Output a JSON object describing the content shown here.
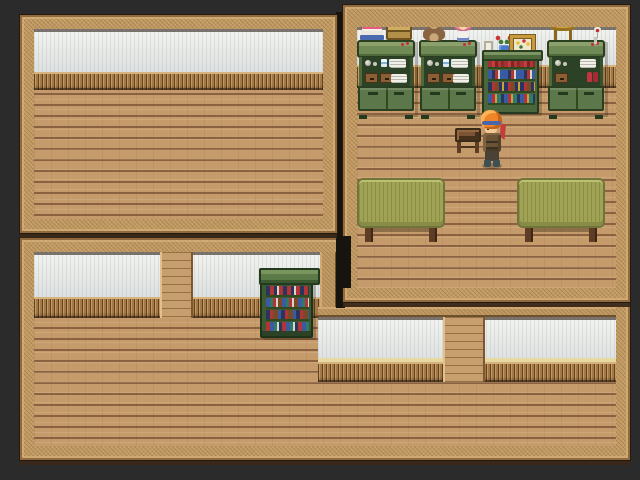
{
  "scene": {
    "type": "rpg-interior-map",
    "background_color": "#2b2b2b",
    "rooms": [
      {
        "id": "top-left-room",
        "label": "empty room"
      },
      {
        "id": "top-right-room",
        "label": "furnished room"
      },
      {
        "id": "bottom-room",
        "label": "long hall"
      }
    ]
  },
  "palette": {
    "bg": "#2b2b2b",
    "gap": "#17130f",
    "frame_base": "#c19a63",
    "wall_white": "#e7e8e4",
    "wainscot": "#b08351",
    "wainscot_rail": "#d7b27c",
    "floor": "#c59b6b",
    "floor_line": "#8a6241",
    "pillar": "#c79e6e",
    "furn_green": "#5c774a",
    "table_top": "#a1a354",
    "leg_brown": "#5f3d24",
    "hair_orange": "#ee8527",
    "headband_blue": "#4a66aa",
    "skin": "#f6c693",
    "outfit_brown": "#6d5134"
  },
  "entities": {
    "character": {
      "name": "player-character",
      "facing": "left"
    },
    "furniture": [
      {
        "id": "dresser-a",
        "items": [
          "book-stack",
          "briefcase",
          "glasses",
          "cups",
          "plates",
          "drawers"
        ]
      },
      {
        "id": "dresser-b",
        "items": [
          "teddy-bear",
          "doll",
          "glasses",
          "cups",
          "plates",
          "drawers"
        ]
      },
      {
        "id": "bookshelf-top",
        "items": [
          "flower-vase",
          "small-frame",
          "framed-picture",
          "books"
        ]
      },
      {
        "id": "dresser-c",
        "items": [
          "gold-stool",
          "wine-glass",
          "red-shoes",
          "plates",
          "drawers"
        ]
      },
      {
        "id": "table-left"
      },
      {
        "id": "table-right"
      },
      {
        "id": "wooden-stool"
      },
      {
        "id": "bookshelf-bottom",
        "items": [
          "books"
        ]
      }
    ]
  }
}
